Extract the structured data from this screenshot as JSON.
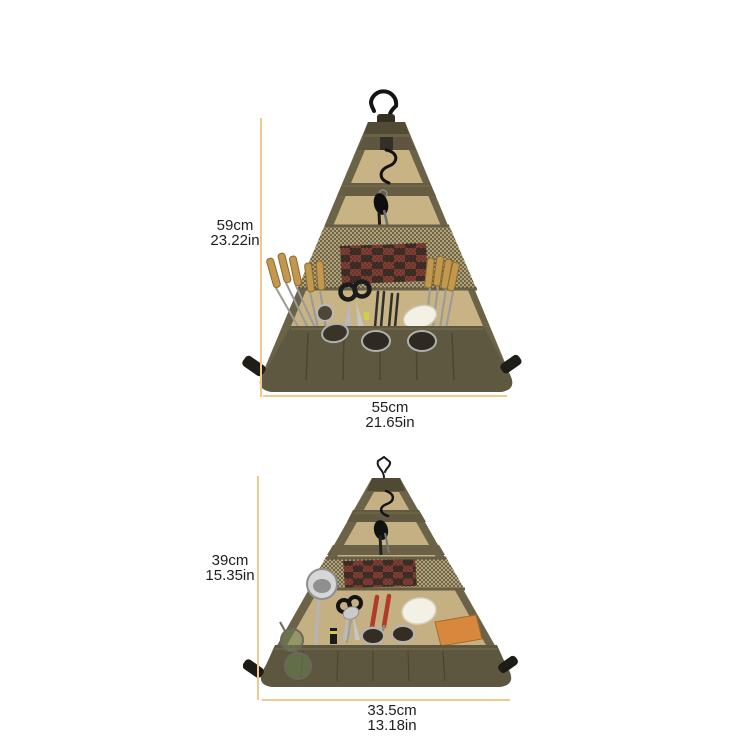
{
  "page": {
    "background_color": "#ffffff",
    "accent_line_color": "#f2c98d",
    "text_color": "#1e1e1e"
  },
  "annotations": {
    "top_product": {
      "height": {
        "cm": "59cm",
        "in": "23.22in"
      },
      "width": {
        "cm": "55cm",
        "in": "21.65in"
      }
    },
    "bottom_product": {
      "height": {
        "cm": "39cm",
        "in": "15.35in"
      },
      "width": {
        "cm": "33.5cm",
        "in": "13.18in"
      }
    }
  },
  "colors": {
    "bag_olive_edge": "#6b6348",
    "bag_olive_band": "#5f5840",
    "bag_olive_dark": "#524b36",
    "bag_tan_panel": "#c7b383",
    "mesh_base": "#b1a176",
    "mesh_dot": "#3f392b",
    "plaid_red": "#8e3a32",
    "plaid_dark": "#2e2420",
    "wood_handle": "#c2974e",
    "metal": "#b9b9b9",
    "cutting_board_orange": "#d8883d",
    "ceramic_white": "#f3f0e5",
    "hook_black": "#141414"
  },
  "icons": {
    "hanger_hook": "question-mark metal hook",
    "s_hook": "S-shaped carabiner hook",
    "corner_buckle": "black side-release strap clip"
  }
}
